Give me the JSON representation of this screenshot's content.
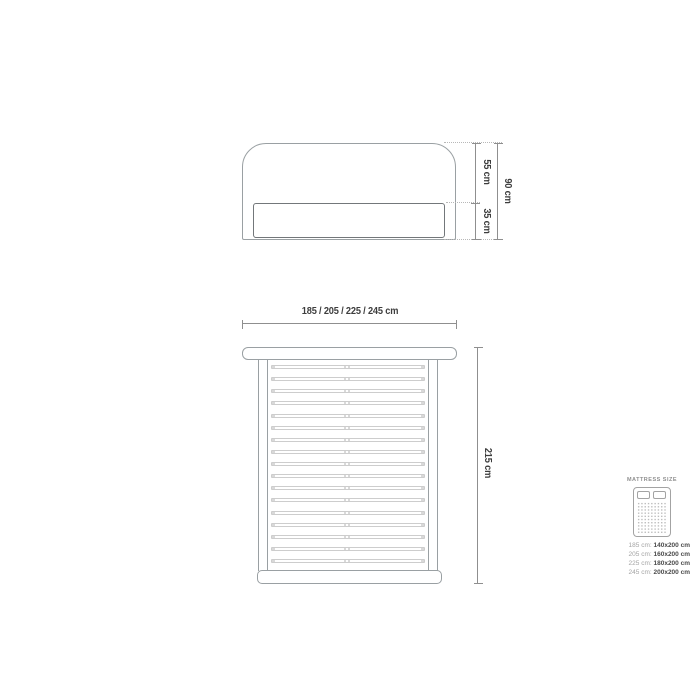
{
  "front_view": {
    "upper_height": "55 cm",
    "lower_height": "35 cm",
    "total_height": "90 cm"
  },
  "top_view": {
    "width_label": "185 / 205 / 225 / 245 cm",
    "length_label": "215 cm",
    "slat_count": 17
  },
  "legend": {
    "title": "MATTRESS SIZE",
    "rows": [
      {
        "frame": "185 cm:",
        "mattress": "140x200 cm"
      },
      {
        "frame": "205 cm:",
        "mattress": "160x200 cm"
      },
      {
        "frame": "225 cm:",
        "mattress": "180x200 cm"
      },
      {
        "frame": "245 cm:",
        "mattress": "200x200 cm"
      }
    ]
  },
  "colors": {
    "outline": "#9aa0a3",
    "outline_dark": "#73777a",
    "slat": "#cdcdcd",
    "slat_cap": "#d9d9d9",
    "dimension_line": "#8f8f8f",
    "dimension_text": "#3d3d3d",
    "extension_dotted": "#b8b8b8",
    "legend_title": "#8f8f8f",
    "legend_muted": "#a3a3a3",
    "legend_value": "#4a4a4a",
    "icon_stroke": "#a3a3a3",
    "icon_dot": "#bdbdbd"
  }
}
